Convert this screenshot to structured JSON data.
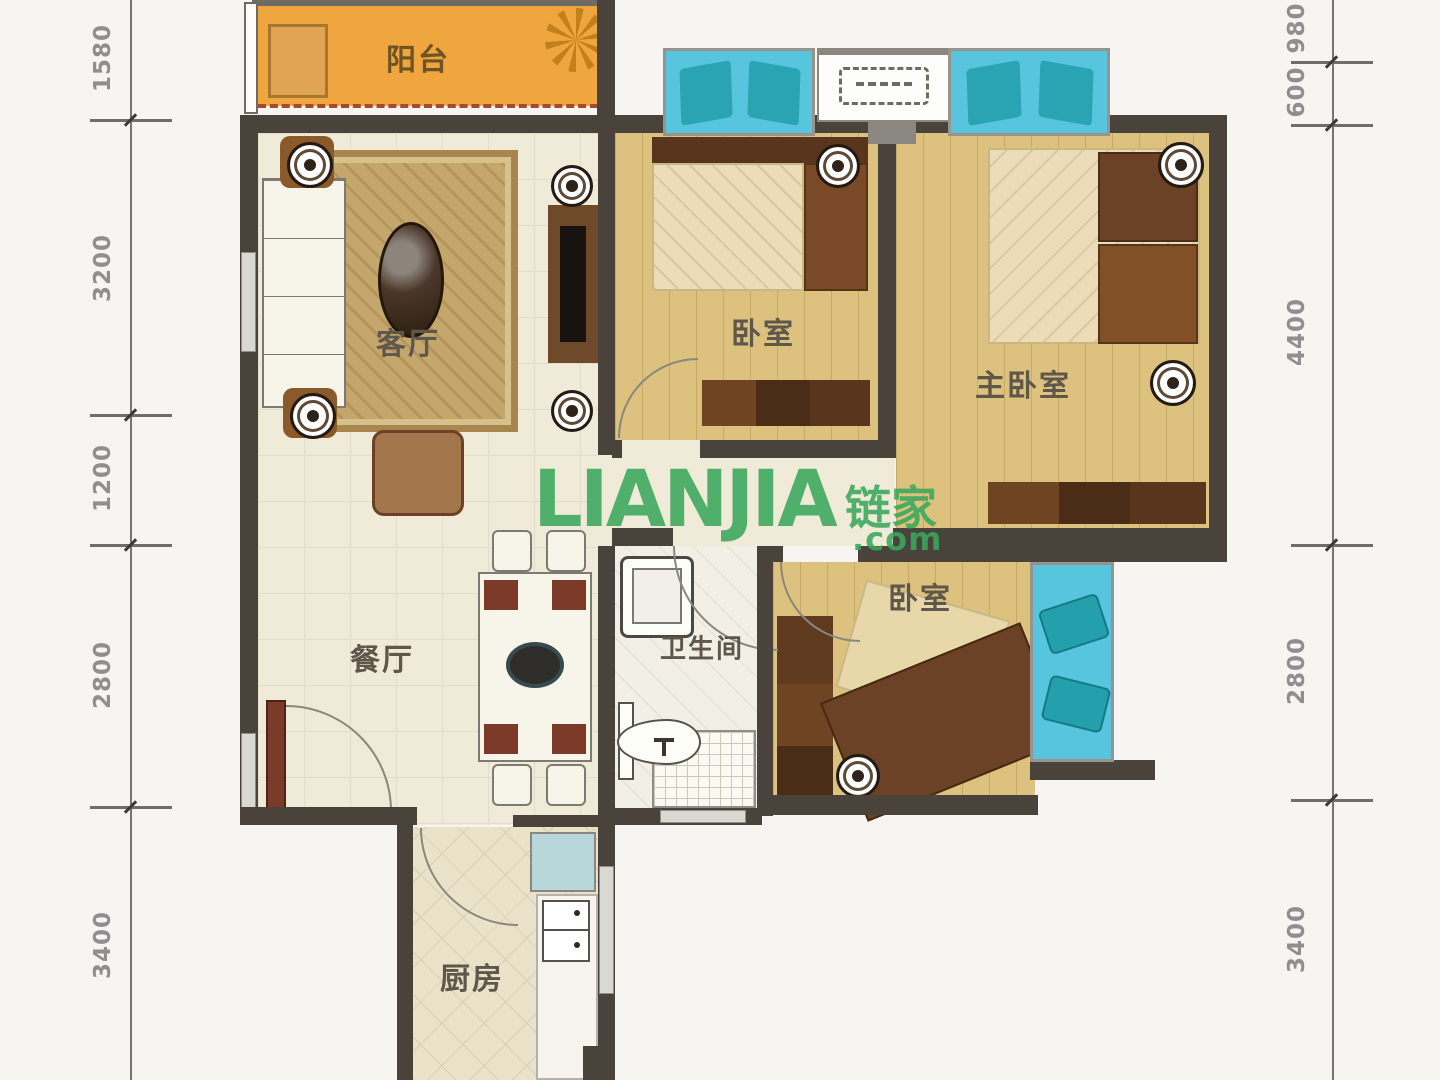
{
  "plan": {
    "rooms": {
      "balcony": "阳台",
      "living_room": "客厅",
      "dining_room": "餐厅",
      "kitchen": "厨房",
      "bathroom": "卫生间",
      "bedroom_top": "卧室",
      "bedroom_lower": "卧室",
      "master_bedroom": "主卧室"
    },
    "dimensions": {
      "left": [
        "1580",
        "3200",
        "1200",
        "2800",
        "3400"
      ],
      "right": [
        "980",
        "600",
        "4400",
        "2800",
        "3400"
      ]
    },
    "watermark": {
      "brand": "LIANJIA",
      "brand_cn": "链家",
      "domain_suffix": ".com"
    },
    "colors": {
      "balcony": "#efa63e",
      "wood_floor": "#ddc27f",
      "bay_window": "#57c5dd",
      "wall": "#49433c",
      "watermark_green": "#3aa85c",
      "dimension_text": "#8f8f8f",
      "label_text": "#5f574a"
    }
  }
}
